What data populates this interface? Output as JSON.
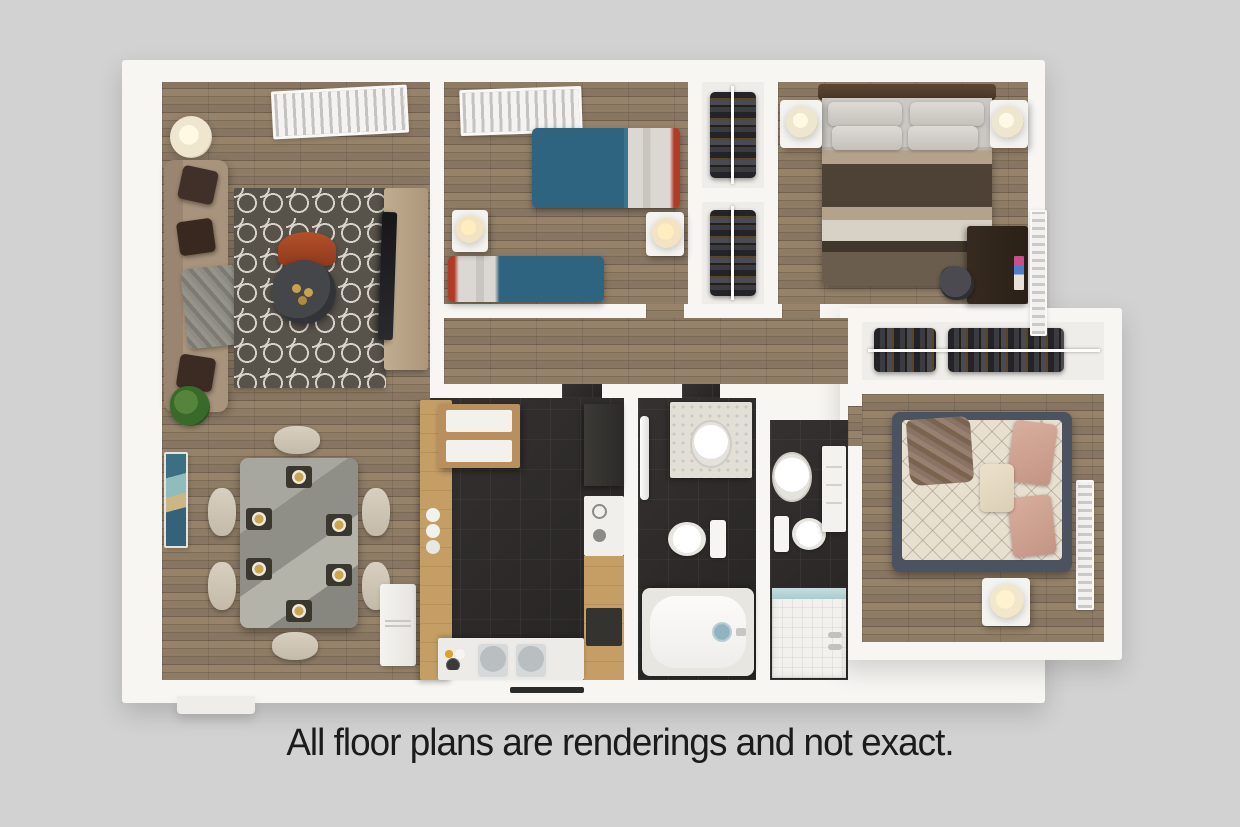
{
  "caption": "All floor plans are renderings and not exact.",
  "plan": {
    "type": "3d-floor-plan-rendering",
    "style": "top-down dollhouse view, white walls, gray background",
    "rooms": [
      {
        "id": "living-room",
        "label": "Living Room",
        "floor": "wood",
        "furniture": [
          "sofa",
          "dark-throw-pillows",
          "gray-throw-blanket",
          "trellis-area-rug",
          "round-coffee-table",
          "orange-accent-chair",
          "tv-console",
          "tv",
          "floor-lamp",
          "ceiling-vent",
          "potted-plant"
        ]
      },
      {
        "id": "dining-area",
        "label": "Dining Area",
        "floor": "wood",
        "furniture": [
          "marble-dining-table",
          "six-place-settings",
          "six-beige-chairs",
          "abstract-wall-art",
          "refrigerator"
        ]
      },
      {
        "id": "kitchen",
        "label": "Kitchen",
        "floor": "dark-tile",
        "furniture": [
          "wood-peninsula-counter",
          "upper-cabinets",
          "range-with-burners",
          "dark-appliance-cabinets",
          "dishwasher",
          "double-sink",
          "window"
        ]
      },
      {
        "id": "bathroom-1",
        "label": "Bathroom 1",
        "floor": "dark-tile",
        "furniture": [
          "vanity-with-sink",
          "towel-bar",
          "toilet",
          "bathtub"
        ]
      },
      {
        "id": "bathroom-2",
        "label": "Bathroom 2",
        "floor": "dark-tile",
        "furniture": [
          "pedestal-sink",
          "toilet",
          "storage-cabinet",
          "tiled-shower-with-glass"
        ]
      },
      {
        "id": "bedroom-2",
        "label": "Bedroom 2",
        "floor": "wood",
        "furniture": [
          "twin-bed-blue-a",
          "twin-bed-blue-b",
          "nightstand-with-lamp-a",
          "nightstand-with-lamp-b",
          "ceiling-vent"
        ]
      },
      {
        "id": "master-bedroom",
        "label": "Master Bedroom",
        "floor": "wood",
        "furniture": [
          "queen-bed-striped-bedding",
          "headboard",
          "four-gray-pillows",
          "nightstand-left-with-lamp",
          "nightstand-right-with-lamp",
          "desk",
          "desk-chair",
          "wall-vent"
        ]
      },
      {
        "id": "bedroom-3",
        "label": "Bedroom 3",
        "floor": "wood",
        "furniture": [
          "bed-diamond-quilt",
          "blush-pillows",
          "brown-throw",
          "nightstand-with-lamp",
          "wall-vent"
        ]
      },
      {
        "id": "hallway",
        "label": "Hallway",
        "floor": "wood",
        "furniture": []
      },
      {
        "id": "closet-column-top",
        "label": "Closet",
        "floor": "white",
        "furniture": [
          "hanging-clothes",
          "closet-rail"
        ]
      },
      {
        "id": "closet-column-bottom",
        "label": "Closet",
        "floor": "white",
        "furniture": [
          "hanging-clothes",
          "closet-rail"
        ]
      },
      {
        "id": "closet-row",
        "label": "Closet",
        "floor": "white",
        "furniture": [
          "hanging-clothes",
          "closet-rail"
        ]
      }
    ],
    "colors": {
      "background": "#d2d2d2",
      "walls": "#f7f6f3",
      "wood_floor": "#8a795f",
      "dark_tile": "#2f2d2b",
      "counter_wood": "#bd945e",
      "bed_blue": "#2f6480",
      "bed_frame_red": "#b03c28",
      "sofa_taupe": "#a08b74",
      "pillow_dark_brown": "#41302a",
      "rug_gray": "#57524a",
      "marble_table": "#9a9a92",
      "chair_beige": "#d0c7b6",
      "master_stripe_brown": "#4e4236",
      "bedroom3_frame_slate": "#4b5361",
      "pillow_blush": "#d3a697",
      "accent_orange": "#b5502a",
      "art_teal": "#3d6f82",
      "shower_glass": "#b9d4d6",
      "caption_text": "#1b1b1b"
    }
  }
}
